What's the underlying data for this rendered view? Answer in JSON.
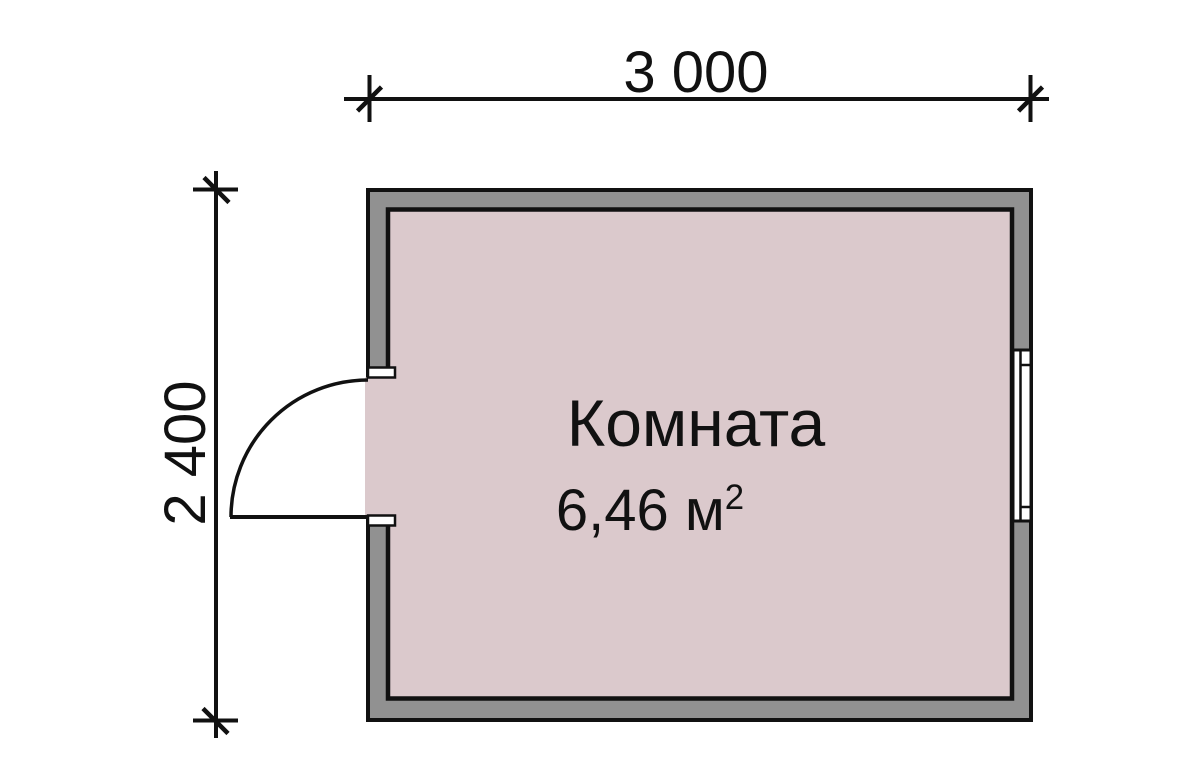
{
  "plan": {
    "dimensions": {
      "width_label": "3 000",
      "height_label": "2 400"
    },
    "room": {
      "name": "Комната",
      "area_value": "6,46 м",
      "area_superscript": "2"
    },
    "colors": {
      "background": "#ffffff",
      "wall_fill": "#919191",
      "room_fill": "#dbc9cc",
      "line": "#111111"
    }
  }
}
